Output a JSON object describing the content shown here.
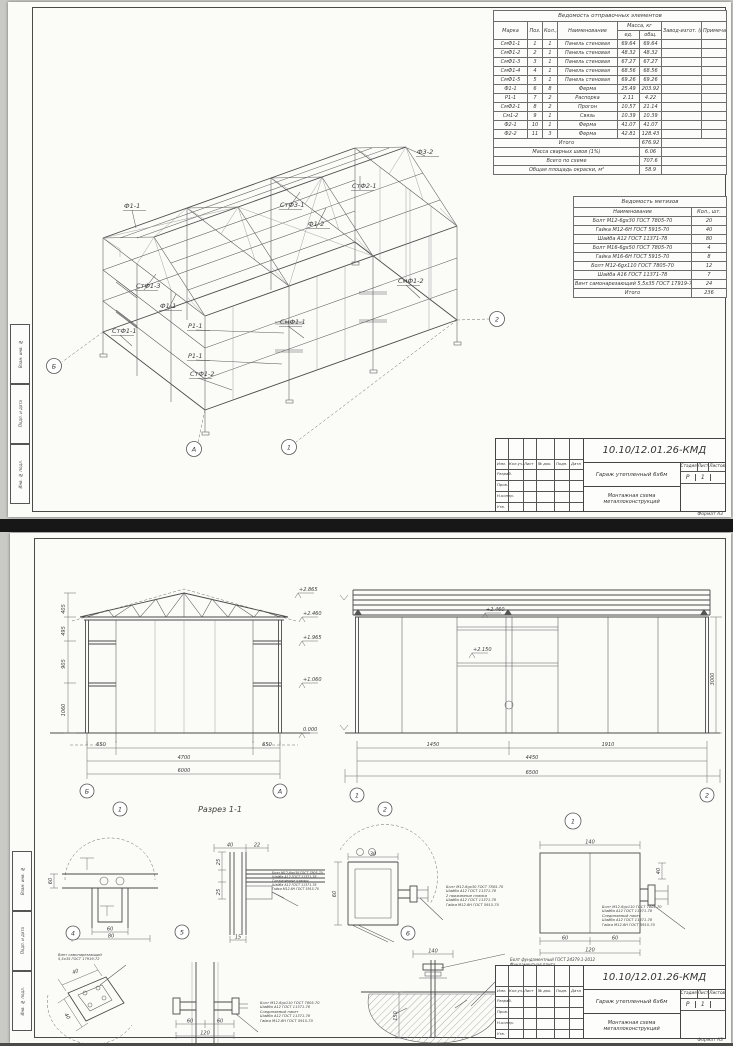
{
  "colors": {
    "sheet": "#fbfbf8",
    "line": "#4a4a4a",
    "divider": "#171717",
    "background": "#c9c9c6"
  },
  "sheet1": {
    "spec_table": {
      "title": "Ведомость отправочных элементов",
      "headers": {
        "marka": "Марка",
        "poz": "Поз.",
        "kol": "Кол., шт.",
        "name": "Наименование",
        "mass": "Масса, кг",
        "ed": "ед.",
        "total": "общ.",
        "zavod": "Завод-изгот. (№ заказа)",
        "note": "Примечание"
      },
      "rows": [
        [
          "СмФ1-1",
          "1",
          "1",
          "Панель стеновая",
          "69.64",
          "69.64"
        ],
        [
          "СмФ1-2",
          "2",
          "1",
          "Панель стеновая",
          "48.32",
          "48.32"
        ],
        [
          "СмФ1-3",
          "3",
          "1",
          "Панель стеновая",
          "67.27",
          "67.27"
        ],
        [
          "СмФ1-4",
          "4",
          "1",
          "Панель стеновая",
          "68.56",
          "68.56"
        ],
        [
          "СмФ1-5",
          "5",
          "1",
          "Панель стеновая",
          "69.26",
          "69.26"
        ],
        [
          "Ф1-1",
          "6",
          "8",
          "Ферма",
          "25.49",
          "203.92"
        ],
        [
          "Р1-1",
          "7",
          "2",
          "Распорка",
          "2.11",
          "4.22"
        ],
        [
          "СмФ2-1",
          "8",
          "2",
          "Прогон",
          "10.57",
          "21.14"
        ],
        [
          "См1-2",
          "9",
          "1",
          "Связь",
          "10.39",
          "10.39"
        ],
        [
          "Ф2-1",
          "10",
          "1",
          "Ферма",
          "41.07",
          "41.07"
        ],
        [
          "Ф2-2",
          "11",
          "3",
          "Ферма",
          "42.81",
          "128.43"
        ]
      ],
      "summary": [
        [
          "Итого",
          "676.92"
        ],
        [
          "Масса сварных швов (1%)",
          "6.06"
        ],
        [
          "Всего по схеме",
          "707.6"
        ],
        [
          "Общая площадь окраски, м²",
          "58.9"
        ]
      ]
    },
    "hardware_table": {
      "title": "Ведомость метизов",
      "headers": {
        "name": "Наименование",
        "qty": "Кол., шт."
      },
      "rows": [
        [
          "Болт М12-6gх30 ГОСТ 7805-70",
          "20"
        ],
        [
          "Гайка М12-6Н ГОСТ 5915-70",
          "40"
        ],
        [
          "Шайба А12 ГОСТ 11371-78",
          "80"
        ],
        [
          "Болт М16-6gх50 ГОСТ 7805-70",
          "4"
        ],
        [
          "Гайка М16-6Н ГОСТ 5915-70",
          "8"
        ],
        [
          "Болт М12-6gх110 ГОСТ 7805-70",
          "12"
        ],
        [
          "Шайба А16 ГОСТ 11371-78",
          "7"
        ],
        [
          "Винт самонарезающий 5,5х35 ГОСТ 17919-72",
          "24"
        ]
      ],
      "total": [
        "Итого",
        "236"
      ]
    },
    "iso": {
      "labels": [
        {
          "t": "Ф3-2",
          "x": 409,
          "y": 152,
          "lx": 399,
          "ly": 146
        },
        {
          "t": "СтФ2-1",
          "x": 344,
          "y": 186,
          "lx": 352,
          "ly": 174
        },
        {
          "t": "СтФ3-1",
          "x": 272,
          "y": 205,
          "lx": 292,
          "ly": 190
        },
        {
          "t": "Ф1-2",
          "x": 300,
          "y": 224,
          "lx": 318,
          "ly": 206
        },
        {
          "t": "Ф1-1",
          "x": 116,
          "y": 206,
          "lx": 128,
          "ly": 226
        },
        {
          "t": "СтФ1-3",
          "x": 128,
          "y": 286,
          "lx": 148,
          "ly": 272
        },
        {
          "t": "Ф1-1",
          "x": 152,
          "y": 306,
          "lx": 168,
          "ly": 292
        },
        {
          "t": "СтФ1-1",
          "x": 104,
          "y": 331,
          "lx": 124,
          "ly": 344
        },
        {
          "t": "Р1-1",
          "x": 180,
          "y": 326,
          "lx": 276,
          "ly": 331
        },
        {
          "t": "Р1-1",
          "x": 180,
          "y": 356,
          "lx": 274,
          "ly": 362
        },
        {
          "t": "СтФ1-2",
          "x": 182,
          "y": 374,
          "lx": 224,
          "ly": 388
        },
        {
          "t": "СмФ1-1",
          "x": 272,
          "y": 322,
          "lx": 296,
          "ly": 336
        },
        {
          "t": "СмФ1-2",
          "x": 390,
          "y": 281,
          "lx": 412,
          "ly": 296
        }
      ],
      "axes": [
        {
          "t": "Б",
          "x": 46,
          "y": 364
        },
        {
          "t": "А",
          "x": 186,
          "y": 447
        },
        {
          "t": "1",
          "x": 281,
          "y": 445
        },
        {
          "t": "2",
          "x": 489,
          "y": 317
        }
      ]
    }
  },
  "sheet2": {
    "section_label": "Разрез 1-1",
    "left_view": {
      "marks": [
        "+2.865",
        "+2.460",
        "+1.965",
        "+1.060",
        "0.000"
      ],
      "side_dims": [
        "405",
        "495",
        "905",
        "1060"
      ],
      "bottom_dims": [
        "650",
        "4700",
        "650",
        "6000"
      ],
      "axes": [
        "Б",
        "А"
      ],
      "node": "1"
    },
    "right_view": {
      "marks": [
        "+2.460",
        "+2.150"
      ],
      "bottom_dims": [
        "1450",
        "1910",
        "4450",
        "6500"
      ],
      "right_dim": "3000",
      "axes": [
        "1",
        "2"
      ],
      "node": "2"
    },
    "details": {
      "d4": {
        "num": "4",
        "dims": [
          "60",
          "80",
          "60"
        ]
      },
      "d5": {
        "num": "5",
        "dims": [
          "40",
          "22",
          "25",
          "25",
          "15"
        ],
        "notes": [
          "Болт М12-6gх30 ГОСТ 7805-70",
          "Шайба А12 ГОСТ 11371-78",
          "Соединяемые планки",
          "Шайба А12 ГОСТ 11371-78",
          "Гайка М12-6Н ГОСТ 5915-70"
        ]
      },
      "d6": {
        "num": "6",
        "dims": [
          "60",
          "30"
        ],
        "notes": [
          "Болт М12-6gх30 ГОСТ 7805-70",
          "Шайба А12 ГОСТ 11371-78",
          "2 прижимные планки",
          "Шайба А12 ГОСТ 11371-78",
          "Гайка М12-6Н ГОСТ 5915-70"
        ]
      },
      "d1": {
        "num": "1",
        "dims": [
          "140",
          "60",
          "60",
          "120",
          "40"
        ],
        "notes": [
          "Болт М12-6gх110 ГОСТ 7805-70",
          "Шайба А12 ГОСТ 11371-78",
          "Соединяемый пакет",
          "Шайба А12 ГОСТ 11371-78",
          "Гайка М12-6Н ГОСТ 5915-70"
        ]
      },
      "screw": {
        "dims": [
          "40",
          "40"
        ],
        "notes": [
          "Винт самонарезающий",
          "5,5х35 ГОСТ 17919-72"
        ]
      },
      "bolt2": {
        "dims": [
          "60",
          "60",
          "120"
        ],
        "notes": [
          "Болт М12-6gх110 ГОСТ 7805-70",
          "Шайба А12 ГОСТ 11371-78",
          "Соединяемый пакет",
          "Шайба А12 ГОСТ 11371-78",
          "Гайка М12-6Н ГОСТ 5915-70"
        ]
      },
      "anchor": {
        "dims": [
          "140",
          "150"
        ],
        "notes": [
          "Болт фундаментный ГОСТ 24379.1-2012",
          "Фундаментная плита"
        ]
      }
    }
  },
  "titleblock": {
    "doc_number": "10.10/12.01.26-КМД",
    "project": "Гараж утепленный 6х6м",
    "drawing_name": "Монтажная схема металлоконструкций",
    "stage_label": "Стадия",
    "sheet_label": "Лист",
    "sheets_label": "Листов",
    "stage": "Р",
    "sheet_no": "1",
    "header_cells": [
      "Изм.",
      "Кол.уч.",
      "Лист",
      "№ док.",
      "Подп.",
      "Дата"
    ],
    "roles": [
      "Разраб.",
      "Пров.",
      "Н.контр.",
      "Утв."
    ],
    "format_note": "Формат А3"
  },
  "margin_stamps": [
    "Инв. № подл.",
    "Подп. и дата",
    "Взам. инв. №"
  ]
}
